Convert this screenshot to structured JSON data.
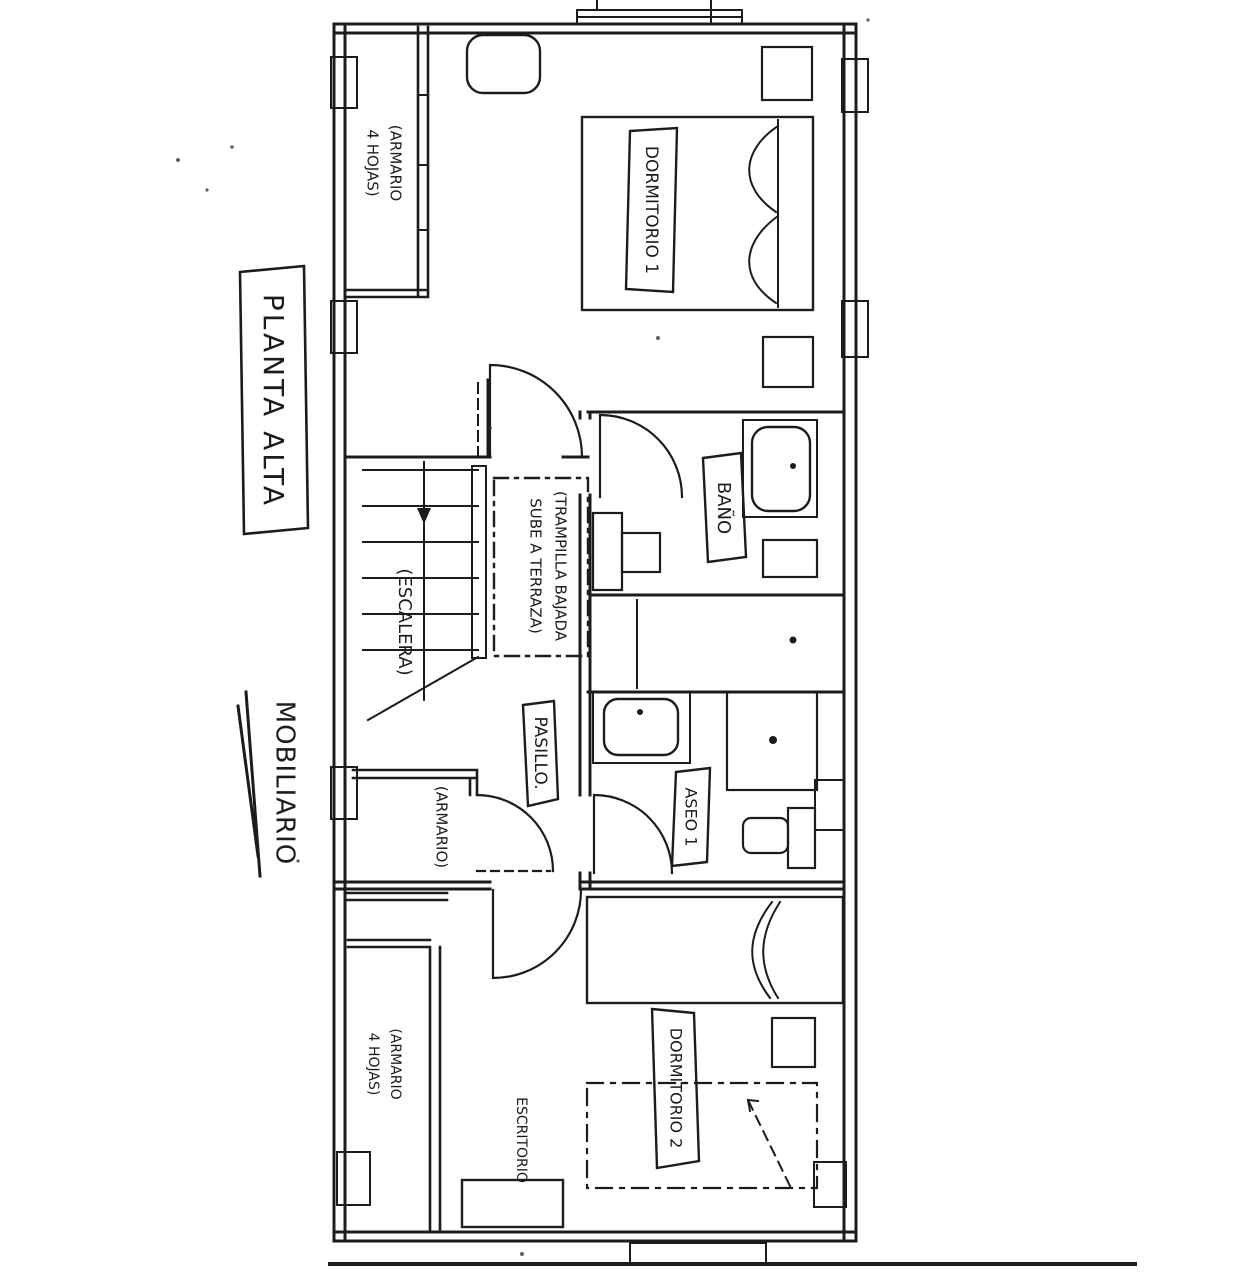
{
  "page": {
    "background": "#ffffff",
    "ink": "#1c1c1c"
  },
  "titles": {
    "plan": "PLANTA ALTA",
    "legend": "MOBILIARIO"
  },
  "rooms": {
    "dormitorio1": "DORMITORIO 1",
    "bano": "BAÑO",
    "aseo1": "ASEO 1",
    "pasillo": "PASILLO.",
    "dormitorio2": "DORMITORIO 2"
  },
  "labels": {
    "escalera": "(ESCALERA)",
    "trampilla_line1": "(TRAMPILLA BAJADA",
    "trampilla_line2": "SUBE A TERRAZA)",
    "armario_dorm1_line1": "(ARMARIO",
    "armario_dorm1_line2": "4 HOJAS)",
    "armario_pasillo": "(ARMARIO)",
    "armario_dorm2_line1": "(ARMARIO",
    "armario_dorm2_line2": "4 HOJAS)",
    "escritorio": "ESCRITORIO"
  }
}
